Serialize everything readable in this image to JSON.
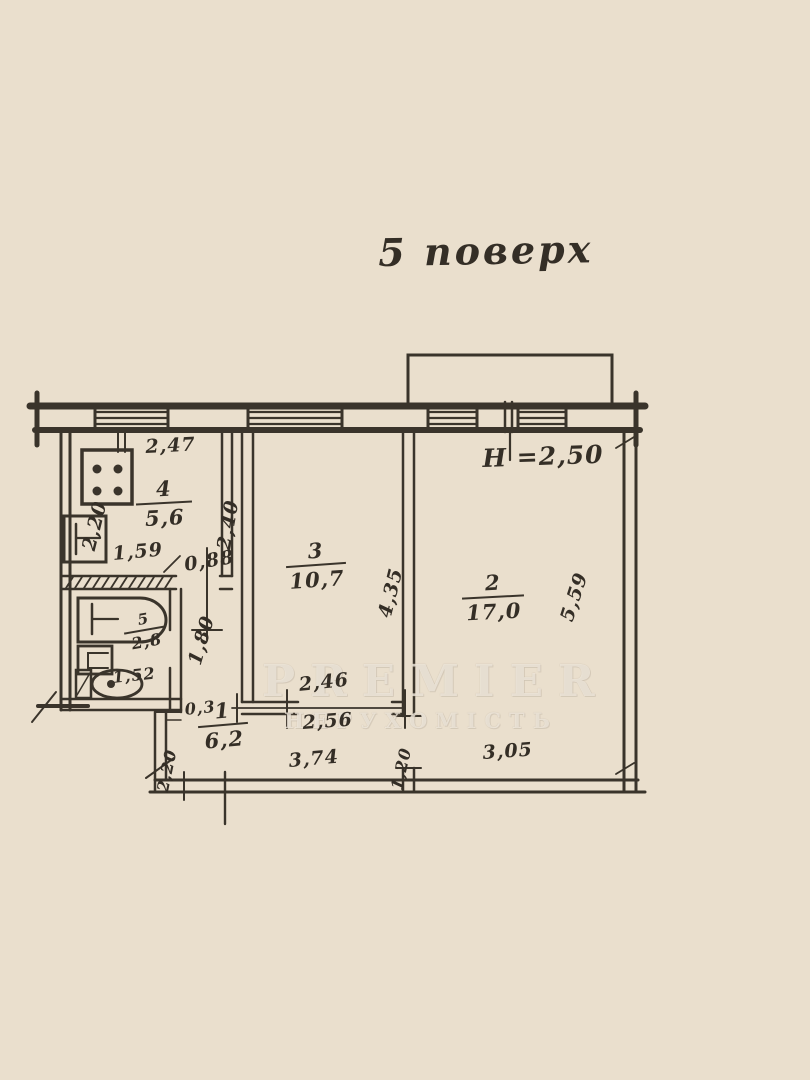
{
  "page": {
    "title": "5 поверх",
    "watermark_line1": "PREMIER",
    "watermark_line2": "НЕРУХОМІСТЬ"
  },
  "plan": {
    "ceiling_height": "H =2,50",
    "rooms": {
      "kitchen": {
        "number": "4",
        "area": "5,6"
      },
      "living": {
        "number": "3",
        "area": "10,7"
      },
      "bedroom": {
        "number": "2",
        "area": "17,0"
      },
      "bathroom": {
        "number": "5",
        "area": "2,8"
      },
      "hallway": {
        "number": "1",
        "area": "6,2"
      }
    },
    "dimensions": {
      "kitchen_width": "2,47",
      "kitchen_depth": "2,40",
      "kitchen_left": "2,20",
      "bathroom_width": "1,59",
      "kitchen_door": "0,88",
      "corridor_width": "1,80",
      "living_depth": "4,35",
      "bedroom_depth": "5,59",
      "living_width_top": "2,46",
      "living_width_bottom": "2,56",
      "toilet_width": "1,52",
      "wall_thickness": "0,3",
      "hall_left": "2,20",
      "hall_width": "3,74",
      "bedroom_door": "1,20",
      "bedroom_width": "3,05"
    }
  }
}
